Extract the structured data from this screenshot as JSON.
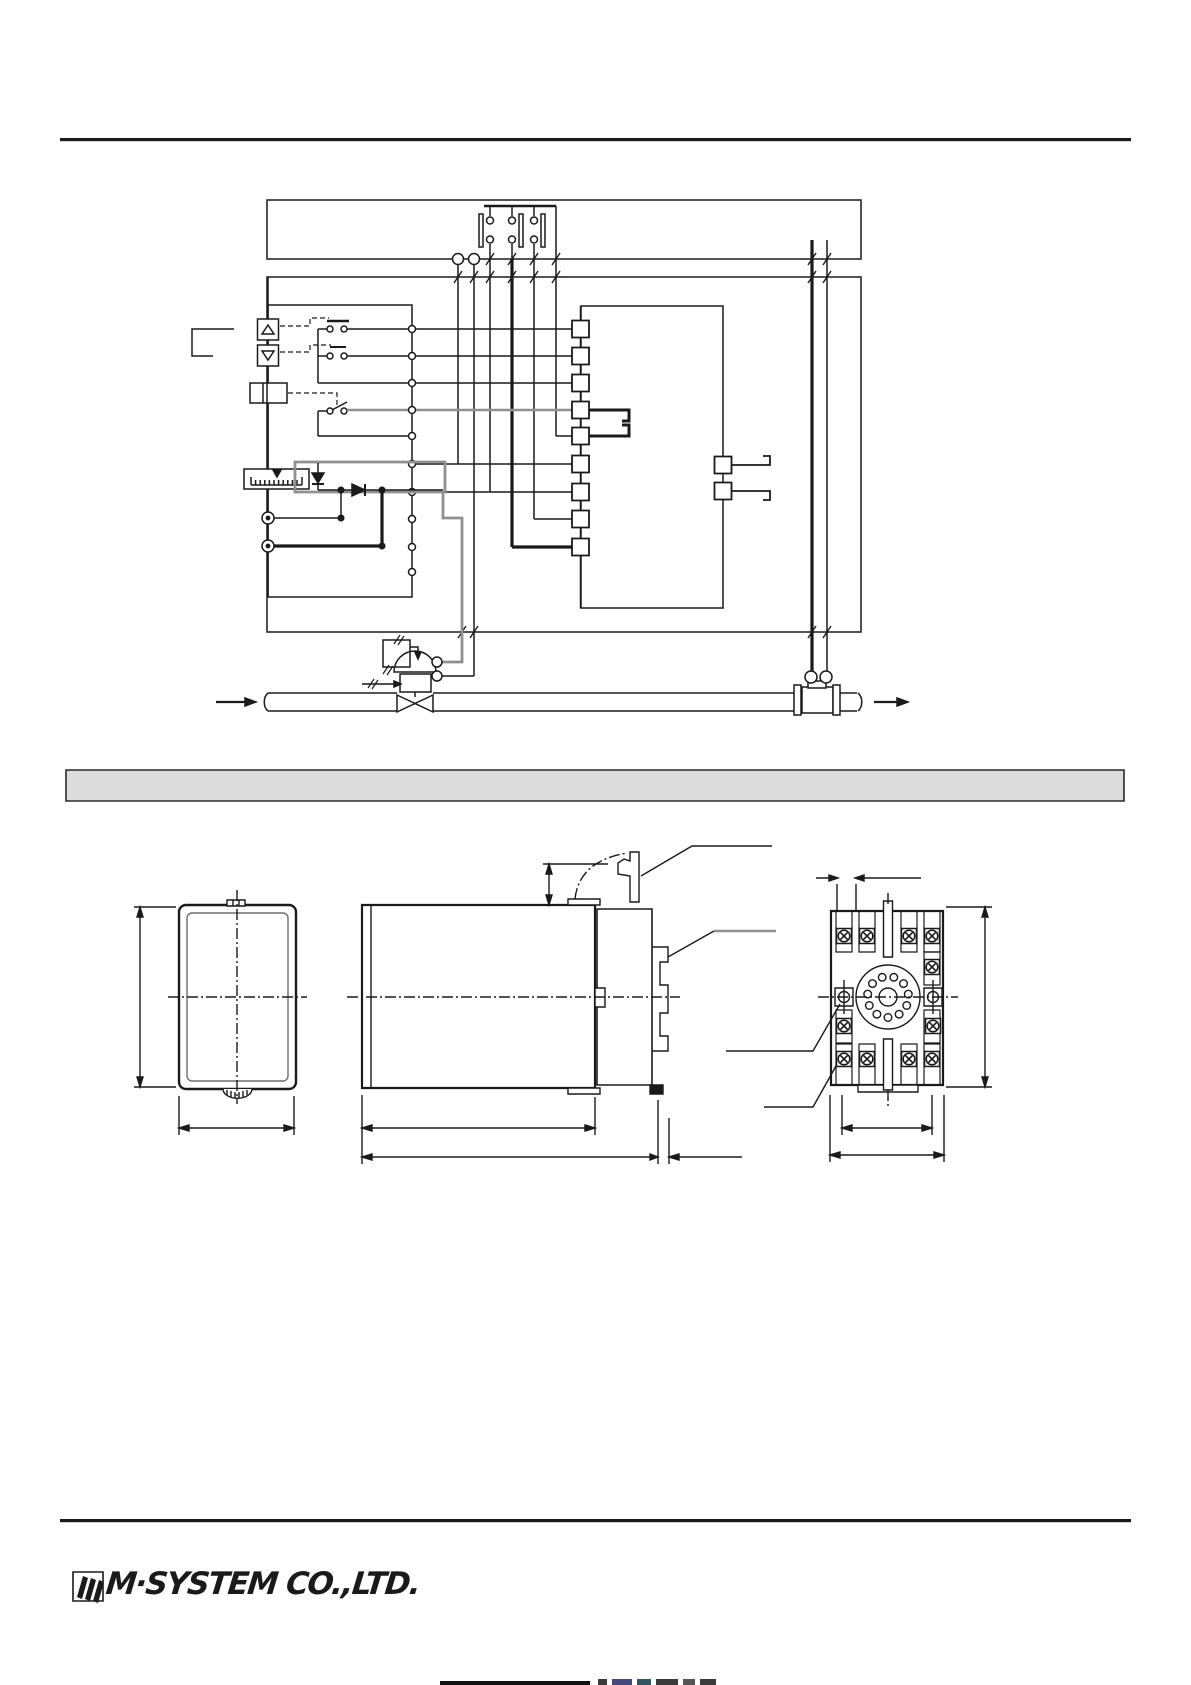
{
  "document": {
    "kind": "instrumentation-datasheet-page"
  },
  "colors": {
    "paper": "#ffffff",
    "ink": "#1a1a1a",
    "gray_line": "#909090",
    "section_bar_fill": "#dcdcdc",
    "inner_panel_line": "#6e6e6e"
  },
  "schematic": {
    "bus_lines": 2,
    "terminal_squares_left_column": 9,
    "terminal_squares_right_column": 2,
    "switch_contacts": 3,
    "setting_buttons": 2,
    "output_circles": 2,
    "flow_sensor_circles": 2
  },
  "drawings": {
    "views": 3,
    "socket_screw_terminals": 11,
    "socket_pin_holes": 11
  },
  "footer": {
    "logo_text": "M·SYSTEM CO.,LTD."
  }
}
